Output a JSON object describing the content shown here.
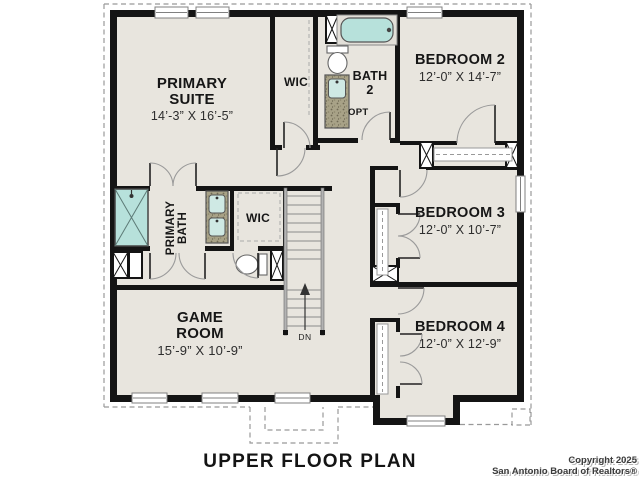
{
  "title": "UPPER FLOOR PLAN",
  "copyright": {
    "line1": "Copyright 2025",
    "line2": "San Antonio Board of Realtors®"
  },
  "rooms": {
    "primary_suite": {
      "name": "PRIMARY SUITE",
      "dims": "14’-3” X 16’-5”"
    },
    "wic_upper": {
      "name": "WIC"
    },
    "bath_2": {
      "name": "BATH 2"
    },
    "bedroom_2": {
      "name": "BEDROOM 2",
      "dims": "12’-0” X 14’-7”"
    },
    "primary_bath": {
      "name": "PRIMARY BATH"
    },
    "wic_middle": {
      "name": "WIC"
    },
    "bedroom_3": {
      "name": "BEDROOM 3",
      "dims": "12’-0” X 10’-7”"
    },
    "game_room": {
      "name": "GAME ROOM",
      "dims": "15’-9” X 10’-9”"
    },
    "bedroom_4": {
      "name": "BEDROOM 4",
      "dims": "12’-0” X 12’-9”"
    }
  },
  "labels": {
    "stairs_down": "DN",
    "optional": "OPT"
  },
  "colors": {
    "wall": "#141414",
    "floor": "#e8e5de",
    "fixture_teal": "#b7e1db",
    "vanity_speckle": "#a8a287",
    "roof_dash": "#999999"
  }
}
